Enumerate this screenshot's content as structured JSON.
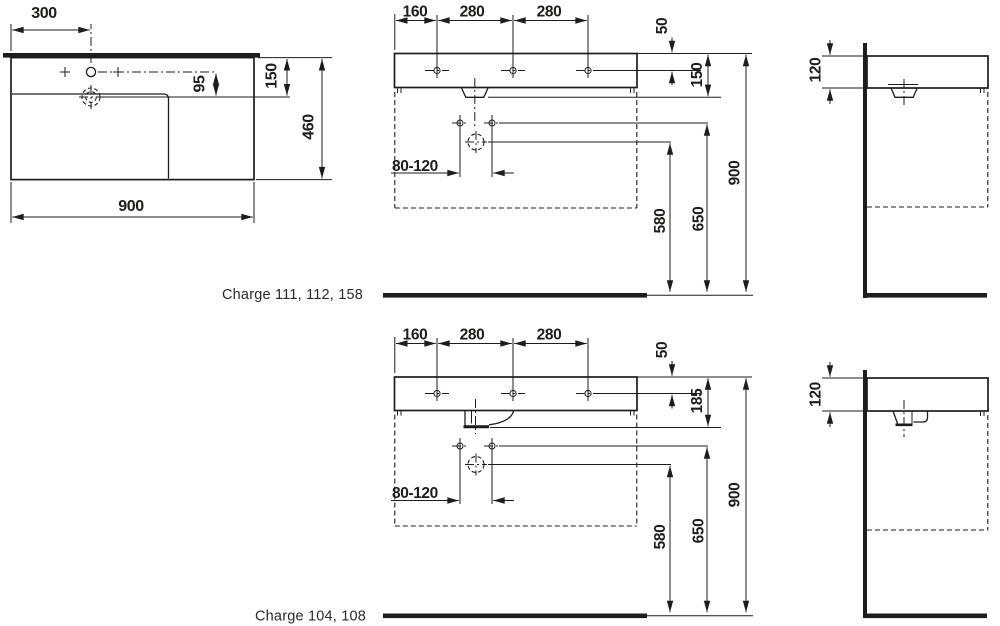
{
  "captions": {
    "top": "Charge 111, 112, 158",
    "bottom": "Charge 104, 108"
  },
  "plan": {
    "tap_offset": "300",
    "tap_to_drain": "95",
    "rim_to_drain": "150",
    "depth": "460",
    "width": "900"
  },
  "front_top": {
    "left_hole": "160",
    "mid_hole": "280",
    "right_hole": "280",
    "top_to_holes": "50",
    "body_height": "150",
    "fixing_span": "80-120",
    "drain_height": "580",
    "holes_height": "650",
    "rim_height": "900"
  },
  "side_top": {
    "body_height": "120"
  },
  "front_bottom": {
    "left_hole": "160",
    "mid_hole": "280",
    "right_hole": "280",
    "top_to_holes": "50",
    "body_height": "185",
    "fixing_span": "80-120",
    "drain_height": "580",
    "holes_height": "650",
    "rim_height": "900"
  },
  "side_bottom": {
    "body_height": "120"
  }
}
